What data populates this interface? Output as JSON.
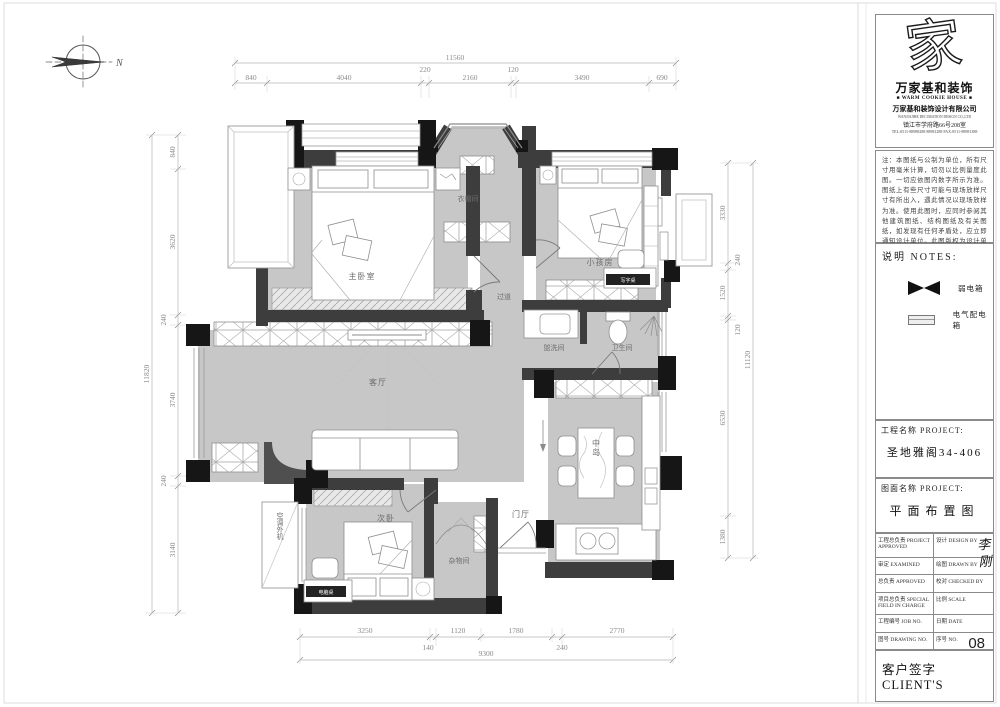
{
  "compass": {
    "north_label": "N"
  },
  "plan": {
    "rooms": [
      {
        "id": "master-bedroom",
        "label": "主卧室"
      },
      {
        "id": "cloakroom",
        "label": "衣帽间"
      },
      {
        "id": "corridor",
        "label": "过道"
      },
      {
        "id": "kids-room",
        "label": "小孩房"
      },
      {
        "id": "washroom",
        "label": "盥洗间"
      },
      {
        "id": "toilet",
        "label": "卫生间"
      },
      {
        "id": "living-room",
        "label": "客厅"
      },
      {
        "id": "island",
        "label": "中岛"
      },
      {
        "id": "entry-hall",
        "label": "门厅"
      },
      {
        "id": "second-bedroom",
        "label": "次卧"
      },
      {
        "id": "storage-room",
        "label": "杂物间"
      }
    ],
    "furniture": {
      "kids_desk": "写字桌",
      "computer_desk": "电脑桌",
      "ac_unit": "空调外机"
    },
    "dims": {
      "top": {
        "overall": "11560",
        "segments": [
          "840",
          "4040",
          "220",
          "2160",
          "120",
          "3490",
          "690"
        ]
      },
      "left": {
        "overall": "11820",
        "segments": [
          "840",
          "3620",
          "240",
          "3740",
          "240",
          "3140"
        ]
      },
      "right": {
        "overall": "11120",
        "segments": [
          "3330",
          "240",
          "1520",
          "120",
          "6530",
          "1380"
        ]
      },
      "bottom": {
        "overall": "9300",
        "segments": [
          "3250",
          "140",
          "1120",
          "1780",
          "240",
          "2770"
        ]
      }
    }
  },
  "title_block": {
    "logo": {
      "glyph": "家",
      "brand": "万家基和装饰",
      "tagline": "■ WARM COOKIE HOUSE ■",
      "company": "万家基和装饰设计有限公司",
      "company_en": "WANJIAJIHE DECORATION DESIGN CO.,LTD",
      "address": "镇江市学府路66号208室",
      "tel": "TEL:0511-88988288 88981288  FAX:0511-88981388"
    },
    "notes": {
      "body": "注：本图纸与公制为单位，所有尺寸用毫米计算，切勿以比例量度此图。一切应依图内数字所示为准。图纸上有些尺寸可能与现场放样尺寸有所出入，遇此情况以现场放样为准。使用此图时，应同时参阅其他建筑图纸、结构图纸及有关图纸，如发现有任何矛盾处，应立即通知设计单位。此图版权为设计单位所有。",
      "heading": "说明  NOTES:"
    },
    "legend": {
      "items": [
        {
          "symbol": "bowtie",
          "label": "弱电箱"
        },
        {
          "symbol": "box",
          "label": "电气配电箱"
        }
      ]
    },
    "project": {
      "label": "工程名称 PROJECT:",
      "value": "圣地雅阁34-406"
    },
    "drawing": {
      "label": "图面名称 PROJECT:",
      "value": "平面布置图"
    },
    "approval": {
      "rows": [
        {
          "left": "工程总负责 PROJECT APPROVED",
          "right": "设计 DESIGN BY"
        },
        {
          "left": "审定 EXAMINED",
          "right": "绘图 DRAWN BY"
        },
        {
          "left": "总负责 APPROVED",
          "right": "校对 CHECKED BY"
        },
        {
          "left": "项目总负责 SPECIAL FIELD IN CHARGE",
          "right": "比例 SCALE"
        },
        {
          "left": "工程编号 JOB NO.",
          "right": "日期 DATE"
        },
        {
          "left": "图号 DRAWING NO.",
          "right": "序号 NO."
        }
      ],
      "serial_no": "08",
      "signature": "李刚"
    },
    "client_label": "客户签字 CLIENT'S"
  }
}
